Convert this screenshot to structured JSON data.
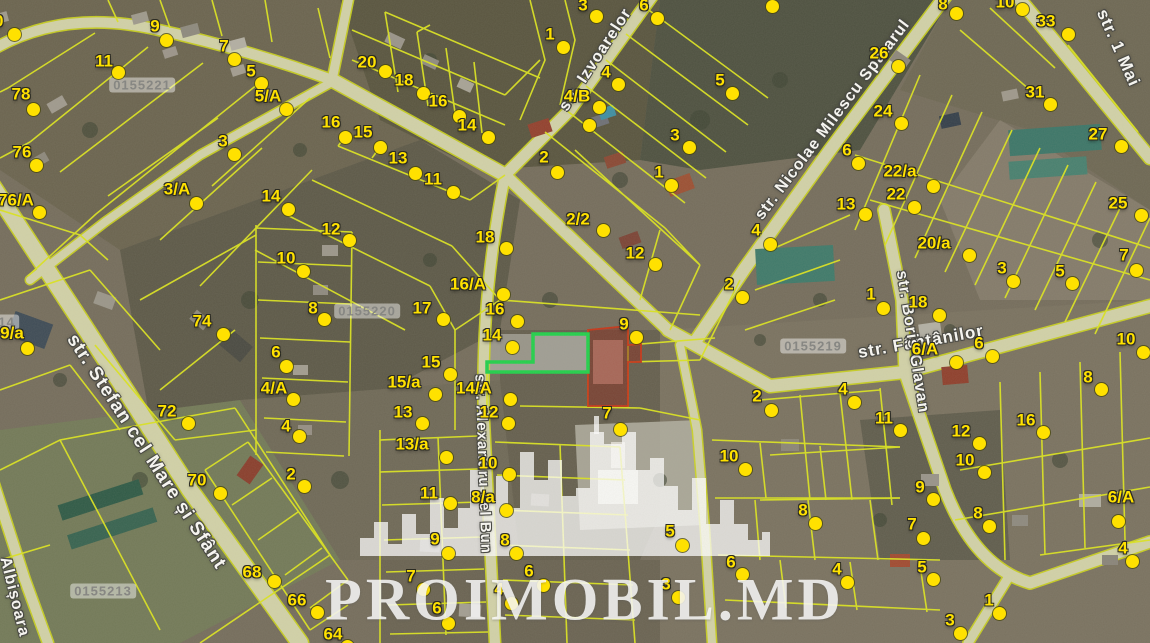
{
  "watermark": {
    "text": "PROIMOBIL.MD"
  },
  "colors": {
    "marker": "#ffe100",
    "parcel_line": "#dce41f",
    "highlight_green": "#22d14b",
    "highlight_red": "#c63618",
    "road": "#d2d2a8"
  },
  "cadastral_labels": [
    {
      "text": "0155221",
      "x": 142,
      "y": 85
    },
    {
      "text": "0155220",
      "x": 367,
      "y": 311
    },
    {
      "text": "0155219",
      "x": 813,
      "y": 346
    },
    {
      "text": "0155213",
      "x": 103,
      "y": 591
    },
    {
      "text": "0155214",
      "x": -14,
      "y": 322
    }
  ],
  "streets": [
    {
      "name": "str. Izvoarelor",
      "x": 596,
      "y": 60,
      "angle": -57,
      "size": 16
    },
    {
      "name": "str. Nicolae Milescu Spătarul",
      "x": 833,
      "y": 120,
      "angle": -53,
      "size": 16
    },
    {
      "name": "str. 1 Mai",
      "x": 1118,
      "y": 48,
      "angle": 66,
      "size": 17
    },
    {
      "name": "str. Fântânilor",
      "x": 921,
      "y": 342,
      "angle": -10,
      "size": 17
    },
    {
      "name": "str. Boris Glavan",
      "x": 912,
      "y": 342,
      "angle": 81,
      "size": 16
    },
    {
      "name": "str. Stefan cel Mare și Sfânt",
      "x": 146,
      "y": 452,
      "angle": 57,
      "size": 19
    },
    {
      "name": "str. Alexandru cel Bun",
      "x": 483,
      "y": 464,
      "angle": 88,
      "size": 15
    },
    {
      "name": "Albișoara",
      "x": 14,
      "y": 597,
      "angle": 76,
      "size": 16
    }
  ],
  "markers": [
    {
      "l": "10",
      "tx": -6,
      "ty": 21,
      "dx": 14,
      "dy": 34
    },
    {
      "l": "9",
      "tx": 155,
      "ty": 26,
      "dx": 166,
      "dy": 40
    },
    {
      "l": "7",
      "tx": 224,
      "ty": 46,
      "dx": 234,
      "dy": 59
    },
    {
      "l": "5",
      "tx": 251,
      "ty": 71,
      "dx": 261,
      "dy": 83
    },
    {
      "l": "5/A",
      "tx": 268,
      "ty": 96,
      "dx": 286,
      "dy": 109
    },
    {
      "l": "11",
      "tx": 104,
      "ty": 61,
      "dx": 118,
      "dy": 72
    },
    {
      "l": "78",
      "tx": 21,
      "ty": 94,
      "dx": 33,
      "dy": 109
    },
    {
      "l": "76",
      "tx": 22,
      "ty": 152,
      "dx": 36,
      "dy": 165
    },
    {
      "l": "76/A",
      "tx": 16,
      "ty": 200,
      "dx": 39,
      "dy": 212
    },
    {
      "l": "3",
      "tx": 223,
      "ty": 141,
      "dx": 234,
      "dy": 154
    },
    {
      "l": "3/A",
      "tx": 177,
      "ty": 189,
      "dx": 196,
      "dy": 203
    },
    {
      "l": "20",
      "tx": 367,
      "ty": 62,
      "dx": 385,
      "dy": 71
    },
    {
      "l": "18",
      "tx": 404,
      "ty": 80,
      "dx": 423,
      "dy": 93
    },
    {
      "l": "16",
      "tx": 438,
      "ty": 101,
      "dx": 459,
      "dy": 116
    },
    {
      "l": "14",
      "tx": 467,
      "ty": 125,
      "dx": 488,
      "dy": 137
    },
    {
      "l": "16",
      "tx": 331,
      "ty": 122,
      "dx": 345,
      "dy": 137
    },
    {
      "l": "15",
      "tx": 363,
      "ty": 132,
      "dx": 380,
      "dy": 147
    },
    {
      "l": "13",
      "tx": 398,
      "ty": 158,
      "dx": 415,
      "dy": 173
    },
    {
      "l": "11",
      "tx": 433,
      "ty": 179,
      "dx": 453,
      "dy": 192
    },
    {
      "l": "14",
      "tx": 271,
      "ty": 196,
      "dx": 288,
      "dy": 209
    },
    {
      "l": "12",
      "tx": 331,
      "ty": 229,
      "dx": 349,
      "dy": 240
    },
    {
      "l": "1",
      "tx": 550,
      "ty": 34,
      "dx": 563,
      "dy": 47
    },
    {
      "l": "3",
      "tx": 583,
      "ty": 5,
      "dx": 596,
      "dy": 16
    },
    {
      "l": "6",
      "tx": 644,
      "ty": 5,
      "dx": 657,
      "dy": 18
    },
    {
      "l": "4",
      "tx": 606,
      "ty": 72,
      "dx": 618,
      "dy": 84
    },
    {
      "l": "4/B",
      "tx": 577,
      "ty": 96,
      "dx": 599,
      "dy": 107
    },
    {
      "l": "",
      "tx": 0,
      "ty": 0,
      "dx": 589,
      "dy": 125
    },
    {
      "l": "2",
      "tx": 544,
      "ty": 157,
      "dx": 557,
      "dy": 172
    },
    {
      "l": "5",
      "tx": 720,
      "ty": 80,
      "dx": 732,
      "dy": 93
    },
    {
      "l": "3",
      "tx": 675,
      "ty": 135,
      "dx": 689,
      "dy": 147
    },
    {
      "l": "1",
      "tx": 659,
      "ty": 172,
      "dx": 671,
      "dy": 185
    },
    {
      "l": "2/2",
      "tx": 578,
      "ty": 219,
      "dx": 603,
      "dy": 230
    },
    {
      "l": "12",
      "tx": 635,
      "ty": 253,
      "dx": 655,
      "dy": 264
    },
    {
      "l": "4",
      "tx": 756,
      "ty": 230,
      "dx": 770,
      "dy": 244
    },
    {
      "l": "2",
      "tx": 729,
      "ty": 284,
      "dx": 742,
      "dy": 297
    },
    {
      "l": "8",
      "tx": 943,
      "ty": 4,
      "dx": 956,
      "dy": 13
    },
    {
      "l": "10",
      "tx": 1005,
      "ty": 2,
      "dx": 1022,
      "dy": 9
    },
    {
      "l": "",
      "tx": 0,
      "ty": 0,
      "dx": 772,
      "dy": 6
    },
    {
      "l": "33",
      "tx": 1046,
      "ty": 21,
      "dx": 1068,
      "dy": 34
    },
    {
      "l": "26",
      "tx": 879,
      "ty": 53,
      "dx": 898,
      "dy": 66
    },
    {
      "l": "31",
      "tx": 1035,
      "ty": 92,
      "dx": 1050,
      "dy": 104
    },
    {
      "l": "24",
      "tx": 883,
      "ty": 111,
      "dx": 901,
      "dy": 123
    },
    {
      "l": "27",
      "tx": 1098,
      "ty": 134,
      "dx": 1121,
      "dy": 146
    },
    {
      "l": "6",
      "tx": 847,
      "ty": 150,
      "dx": 858,
      "dy": 163
    },
    {
      "l": "22/a",
      "tx": 900,
      "ty": 171,
      "dx": 933,
      "dy": 186
    },
    {
      "l": "22",
      "tx": 896,
      "ty": 194,
      "dx": 914,
      "dy": 207
    },
    {
      "l": "13",
      "tx": 846,
      "ty": 204,
      "dx": 865,
      "dy": 214
    },
    {
      "l": "25",
      "tx": 1118,
      "ty": 203,
      "dx": 1141,
      "dy": 215
    },
    {
      "l": "20/a",
      "tx": 934,
      "ty": 243,
      "dx": 969,
      "dy": 255
    },
    {
      "l": "3",
      "tx": 1002,
      "ty": 268,
      "dx": 1013,
      "dy": 281
    },
    {
      "l": "5",
      "tx": 1060,
      "ty": 271,
      "dx": 1072,
      "dy": 283
    },
    {
      "l": "7",
      "tx": 1124,
      "ty": 255,
      "dx": 1136,
      "dy": 270
    },
    {
      "l": "1",
      "tx": 871,
      "ty": 294,
      "dx": 883,
      "dy": 308
    },
    {
      "l": "18",
      "tx": 918,
      "ty": 302,
      "dx": 939,
      "dy": 315
    },
    {
      "l": "6/A",
      "tx": 925,
      "ty": 349,
      "dx": 956,
      "dy": 362
    },
    {
      "l": "6",
      "tx": 979,
      "ty": 343,
      "dx": 992,
      "dy": 356
    },
    {
      "l": "10",
      "tx": 1126,
      "ty": 339,
      "dx": 1143,
      "dy": 352
    },
    {
      "l": "2",
      "tx": 757,
      "ty": 396,
      "dx": 771,
      "dy": 410
    },
    {
      "l": "4",
      "tx": 843,
      "ty": 389,
      "dx": 854,
      "dy": 402
    },
    {
      "l": "8",
      "tx": 1088,
      "ty": 377,
      "dx": 1101,
      "dy": 389
    },
    {
      "l": "16",
      "tx": 1026,
      "ty": 420,
      "dx": 1043,
      "dy": 432
    },
    {
      "l": "11",
      "tx": 884,
      "ty": 418,
      "dx": 900,
      "dy": 430
    },
    {
      "l": "12",
      "tx": 961,
      "ty": 431,
      "dx": 979,
      "dy": 443
    },
    {
      "l": "9/a",
      "tx": 12,
      "ty": 333,
      "dx": 27,
      "dy": 348
    },
    {
      "l": "74",
      "tx": 202,
      "ty": 321,
      "dx": 223,
      "dy": 334
    },
    {
      "l": "72",
      "tx": 167,
      "ty": 411,
      "dx": 188,
      "dy": 423
    },
    {
      "l": "10",
      "tx": 286,
      "ty": 258,
      "dx": 303,
      "dy": 271
    },
    {
      "l": "8",
      "tx": 313,
      "ty": 308,
      "dx": 324,
      "dy": 319
    },
    {
      "l": "6",
      "tx": 276,
      "ty": 352,
      "dx": 286,
      "dy": 366
    },
    {
      "l": "4/A",
      "tx": 274,
      "ty": 388,
      "dx": 293,
      "dy": 399
    },
    {
      "l": "4",
      "tx": 286,
      "ty": 426,
      "dx": 299,
      "dy": 436
    },
    {
      "l": "2",
      "tx": 291,
      "ty": 474,
      "dx": 304,
      "dy": 486
    },
    {
      "l": "70",
      "tx": 197,
      "ty": 480,
      "dx": 220,
      "dy": 493
    },
    {
      "l": "68",
      "tx": 252,
      "ty": 572,
      "dx": 274,
      "dy": 581
    },
    {
      "l": "66",
      "tx": 297,
      "ty": 600,
      "dx": 317,
      "dy": 612
    },
    {
      "l": "64",
      "tx": 333,
      "ty": 634,
      "dx": 347,
      "dy": 646
    },
    {
      "l": "17",
      "tx": 422,
      "ty": 308,
      "dx": 443,
      "dy": 319
    },
    {
      "l": "16/A",
      "tx": 468,
      "ty": 284,
      "dx": 503,
      "dy": 294
    },
    {
      "l": "16",
      "tx": 495,
      "ty": 309,
      "dx": 517,
      "dy": 321
    },
    {
      "l": "14",
      "tx": 492,
      "ty": 335,
      "dx": 512,
      "dy": 347
    },
    {
      "l": "15",
      "tx": 431,
      "ty": 362,
      "dx": 450,
      "dy": 374
    },
    {
      "l": "15/a",
      "tx": 404,
      "ty": 382,
      "dx": 435,
      "dy": 394
    },
    {
      "l": "14/A",
      "tx": 474,
      "ty": 388,
      "dx": 510,
      "dy": 399
    },
    {
      "l": "13",
      "tx": 403,
      "ty": 412,
      "dx": 422,
      "dy": 423
    },
    {
      "l": "12",
      "tx": 489,
      "ty": 412,
      "dx": 508,
      "dy": 423
    },
    {
      "l": "18",
      "tx": 485,
      "ty": 237,
      "dx": 506,
      "dy": 248
    },
    {
      "l": "9",
      "tx": 624,
      "ty": 324,
      "dx": 636,
      "dy": 337
    },
    {
      "l": "7",
      "tx": 607,
      "ty": 413,
      "dx": 620,
      "dy": 429
    },
    {
      "l": "13/a",
      "tx": 412,
      "ty": 444,
      "dx": 446,
      "dy": 457
    },
    {
      "l": "10",
      "tx": 488,
      "ty": 463,
      "dx": 509,
      "dy": 474
    },
    {
      "l": "11",
      "tx": 429,
      "ty": 493,
      "dx": 450,
      "dy": 503
    },
    {
      "l": "8/a",
      "tx": 483,
      "ty": 497,
      "dx": 506,
      "dy": 510
    },
    {
      "l": "9",
      "tx": 435,
      "ty": 539,
      "dx": 448,
      "dy": 553
    },
    {
      "l": "8",
      "tx": 505,
      "ty": 540,
      "dx": 516,
      "dy": 553
    },
    {
      "l": "7",
      "tx": 411,
      "ty": 576,
      "dx": 423,
      "dy": 589
    },
    {
      "l": "6",
      "tx": 529,
      "ty": 571,
      "dx": 543,
      "dy": 585
    },
    {
      "l": "4",
      "tx": 499,
      "ty": 589,
      "dx": 511,
      "dy": 603
    },
    {
      "l": "6",
      "tx": 437,
      "ty": 608,
      "dx": 448,
      "dy": 623
    },
    {
      "l": "5",
      "tx": 670,
      "ty": 531,
      "dx": 682,
      "dy": 545
    },
    {
      "l": "3",
      "tx": 666,
      "ty": 584,
      "dx": 678,
      "dy": 597
    },
    {
      "l": "10",
      "tx": 729,
      "ty": 456,
      "dx": 745,
      "dy": 469
    },
    {
      "l": "6",
      "tx": 731,
      "ty": 562,
      "dx": 742,
      "dy": 574
    },
    {
      "l": "10",
      "tx": 965,
      "ty": 460,
      "dx": 984,
      "dy": 472
    },
    {
      "l": "9",
      "tx": 920,
      "ty": 487,
      "dx": 933,
      "dy": 499
    },
    {
      "l": "8",
      "tx": 978,
      "ty": 513,
      "dx": 989,
      "dy": 526
    },
    {
      "l": "7",
      "tx": 912,
      "ty": 524,
      "dx": 923,
      "dy": 538
    },
    {
      "l": "5",
      "tx": 922,
      "ty": 567,
      "dx": 933,
      "dy": 579
    },
    {
      "l": "8",
      "tx": 803,
      "ty": 510,
      "dx": 815,
      "dy": 523
    },
    {
      "l": "4",
      "tx": 837,
      "ty": 569,
      "dx": 847,
      "dy": 582
    },
    {
      "l": "1",
      "tx": 989,
      "ty": 600,
      "dx": 999,
      "dy": 613
    },
    {
      "l": "3",
      "tx": 950,
      "ty": 620,
      "dx": 960,
      "dy": 633
    },
    {
      "l": "6/A",
      "tx": 1121,
      "ty": 497,
      "dx": 1118,
      "dy": 521
    },
    {
      "l": "4",
      "tx": 1123,
      "ty": 548,
      "dx": 1132,
      "dy": 561
    }
  ]
}
